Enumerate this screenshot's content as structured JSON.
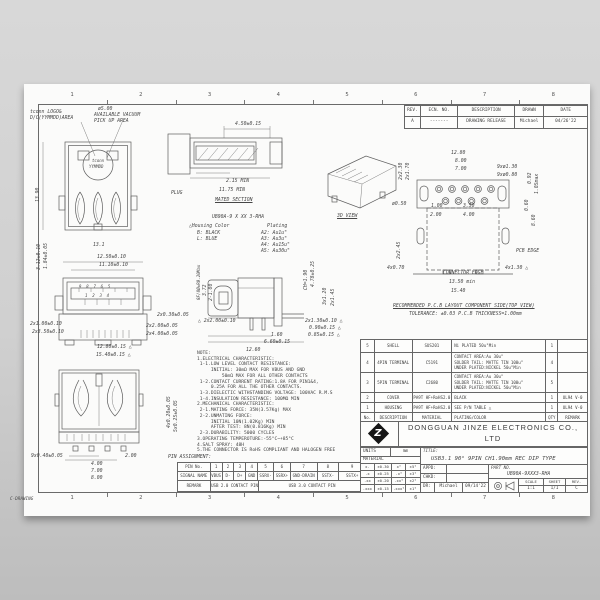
{
  "frame": {
    "columns": [
      "1",
      "2",
      "3",
      "4",
      "5",
      "6",
      "7",
      "8"
    ],
    "corner_label": "C-DRAWING"
  },
  "revision_table": {
    "headers": [
      "REV.",
      "ECN. NO.",
      "DESCRIPTION",
      "DRAWN",
      "DATE"
    ],
    "rows": [
      [
        "A",
        "-------",
        "DRAWING RELEASE",
        "Michael",
        "04/26'22"
      ]
    ]
  },
  "views": {
    "tv": {
      "callout_logo_1": "tconn LOGO&",
      "callout_logo_2": "D/C(YYMMDD)AREA",
      "callout_vac_1": "ø5.00",
      "callout_vac_2": "AVAILABLE VACUUM",
      "callout_vac_3": "PICK UP AREA",
      "logo_top": "tconn",
      "logo_bottom": "YYMMDD",
      "dim_height": "13.90",
      "dim_width": "13.1"
    },
    "ms": {
      "plug_label": "PLUG",
      "section_label": "MATED SECTION",
      "dim_top": "4.50±0.15",
      "dim_min1": "2.15 MIN",
      "dim_min2": "11.75 MIN"
    },
    "pn": {
      "code": "UB90A-9 X XX 3-RHA",
      "housing_title": "△Housing Color",
      "housing_b": "B: BLACK",
      "housing_l": "L: BLUE",
      "plating_title": "Plating",
      "a2": "A2: Au1u\"",
      "a3": "A3: Au3u\"",
      "a4": "A4: Au15u\"",
      "a5": "A5: Au30u\""
    },
    "v3d": {
      "label": "3D VIEW"
    },
    "pcb": {
      "d1": "12.80",
      "d2": "8.00",
      "d3": "7.00",
      "d4": "9xø1.30",
      "d5": "9xø0.80",
      "d6": "0.92",
      "d7": "1.05max",
      "d8": "2x2.30",
      "d9": "2x1.70",
      "d10": "ø0.50",
      "d11": "1.00",
      "d12": "3.50",
      "d13": "2.00",
      "d14": "4.00",
      "d15": "0.60",
      "d16": "8.60",
      "d17": "2x2.45",
      "d18": "4x0.70",
      "d19": "4x1.30 △",
      "d20": "13.50 min",
      "d21": "15.40",
      "pcb_edge": "PCB EDGE",
      "conn_edge": "CONNECTOR EDGE",
      "note1": "RECOMMENDED P.C.B LAYOUT COMPONENT SIDE(TOP VIEW)",
      "note2": "TOLERANCE: ±0.03 P.C.B THICKNESS=1.00mm"
    },
    "fv": {
      "d1": "12.50±0.10",
      "d2": "11.10±0.10",
      "d3": "3.12±0.10",
      "d4": "1.84±0.05",
      "d5": "2x1.00±0.10",
      "d6": "2x3.50±0.10",
      "d7": "2x0.30±0.05",
      "d8": "2x2.00±0.05",
      "d9": "2x4.00±0.05",
      "d10": "12.80±0.15 △",
      "d11": "15.40±0.15 △",
      "pins_top": "9  8  7  6  5",
      "pins_bottom": "1  2  3  4"
    },
    "sv": {
      "d1": "△ 2x2.00±0.10",
      "d2": "CH=1.90",
      "d3": "4.78±0.25",
      "d4": "3x1.20",
      "d5": "2x1.45",
      "d6": "2x1.30±0.10 △",
      "d7": "0.90±0.15 △",
      "d8": "0.85±0.15 △",
      "d9": "1.60",
      "d10": "6.60±0.15",
      "d11": "12.60",
      "d12": "3.72",
      "d13": "2-1.00",
      "d14": "8F/8Ø±R0.20Max"
    },
    "bv": {
      "d1": "4x0.20±0.05",
      "d2": "5x0.25±0.05",
      "d3": "9x0.40±0.05",
      "d4": "2.00",
      "d5": "4.00",
      "d6": "7.00",
      "d7": "8.00"
    }
  },
  "notes": {
    "lines": [
      "NOTE:",
      "1.ELECTRICAL CHARACTERISTIC:",
      " 1-1.LOW LEVEL CONTACT RESISTANCE:",
      "     INITIAL: 30mΩ MAX FOR VBUS AND GND",
      "         50mΩ MAX FOR ALL OTHER CONTACTS",
      " 1-2.CONTACT CURRENT RATING:1.8A FOR PIN1&4,",
      "     0.25A FOR ALL THE OTHER CONTACTS.",
      " 1-3.DIELECTIC WITHSTANDING VOLTAGE: 100VAC R.M.S",
      " 1-4.INSULATION RESISTANCE: 100MΩ MIN",
      "2.MECHANICAL CHARACTERISTIC:",
      " 2-1.MATING FORCE: 35N(3.57Kg) MAX",
      " 2-2.UNMATING FORCE:",
      "     INITIAL 10N(1.02Kg) MIN",
      "     AFTER TEST: 8N(0.816Kg) MIN",
      " 2-3.DURABILITY: 5000 CYCLES",
      "3.OPERATING TEMPEROTURE:-55°C~+85°C",
      "4.SALT SPRAY: 48H",
      "5.THE CONNECTOR IS RoHS COMPLIANT AND HALOGEN FREE"
    ]
  },
  "pin_table": {
    "title": "PIN ASSIGNMENT:",
    "row1": [
      "PIN No.",
      "1",
      "2",
      "3",
      "4",
      "5",
      "6",
      "7",
      "8",
      "9"
    ],
    "row2": [
      "SIGNAL NAME",
      "VBUS",
      "D-",
      "D+",
      "GND",
      "SSRX-",
      "SSRX+",
      "GND-DRAIN",
      "SSTX-",
      "SSTX+"
    ],
    "row3_label": "REMARK",
    "row3_usb2": "USB 2.0 CONTACT PIN",
    "row3_usb3": "USB 3.0 CONTACT PIN"
  },
  "bom": {
    "headers": [
      "No.",
      "DESCRIPTION",
      "MATERIAL",
      "PLATING/COLOR",
      "QTY",
      "REMARK"
    ],
    "rows": [
      [
        "5",
        "SHELL",
        "SUS201",
        "Ni PLATED 50u\"Min",
        "1",
        ""
      ],
      [
        "4",
        "4PIN TERMINAL",
        "C5191",
        "CONTACT AREA:Au 30u\"\nSOLDER TAIL: MATTE TIN 100u\"\nUNDER PLATED:NICKEL 50u\"Min",
        "4",
        ""
      ],
      [
        "3",
        "5PIN TERMINAL",
        "C2680",
        "CONTACT AREA:Au 30u\"\nSOLDER TAIL: MATTE TIN 100u\"\nUNDER PLATED:NICKEL 50u\"Min",
        "5",
        ""
      ],
      [
        "2",
        "COVER",
        "PA9T HF+RoHS2.0",
        "BLACK",
        "1",
        "UL94 V-0"
      ],
      [
        "1",
        "HOUSING",
        "PA9T HF+RoHS2.0",
        "SEE P/N TABLE △",
        "1",
        "UL94 V-0"
      ]
    ]
  },
  "company": {
    "name": "DONGGUAN JINZE ELECTRONICS CO., LTD",
    "logo_letter": "Z"
  },
  "title_block": {
    "units_label": "UNITS",
    "units_value": "mm",
    "material_label": "MATERIAL",
    "tolerance_rows": [
      [
        "x.",
        "±0.30",
        "x°",
        "±5°"
      ],
      [
        ".x",
        "±0.25",
        ".x°",
        "±3°"
      ],
      [
        ".xx",
        "±0.20",
        ".xx°",
        "±2°"
      ],
      [
        ".xxx",
        "±0.15",
        ".xxx°",
        "±1°"
      ]
    ],
    "title_label": "TITLE:",
    "title": "USB3.1 90° 9PIN CH1.90mm REC DIP TYPE",
    "appd_label": "APPD:",
    "chkd_label": "CHKD:",
    "dr_label": "DR:",
    "drawn_by": "Michael",
    "drawn_date": "09/14'22",
    "part_no_label": "PART NO.",
    "part_no": "UB90A-9XXX3-RHA",
    "scale_label": "SCALE",
    "scale_value": "1:1",
    "sheet_label": "SHEET",
    "sheet_value": "1/1",
    "rev_label": "REV.",
    "rev_value": "C"
  }
}
